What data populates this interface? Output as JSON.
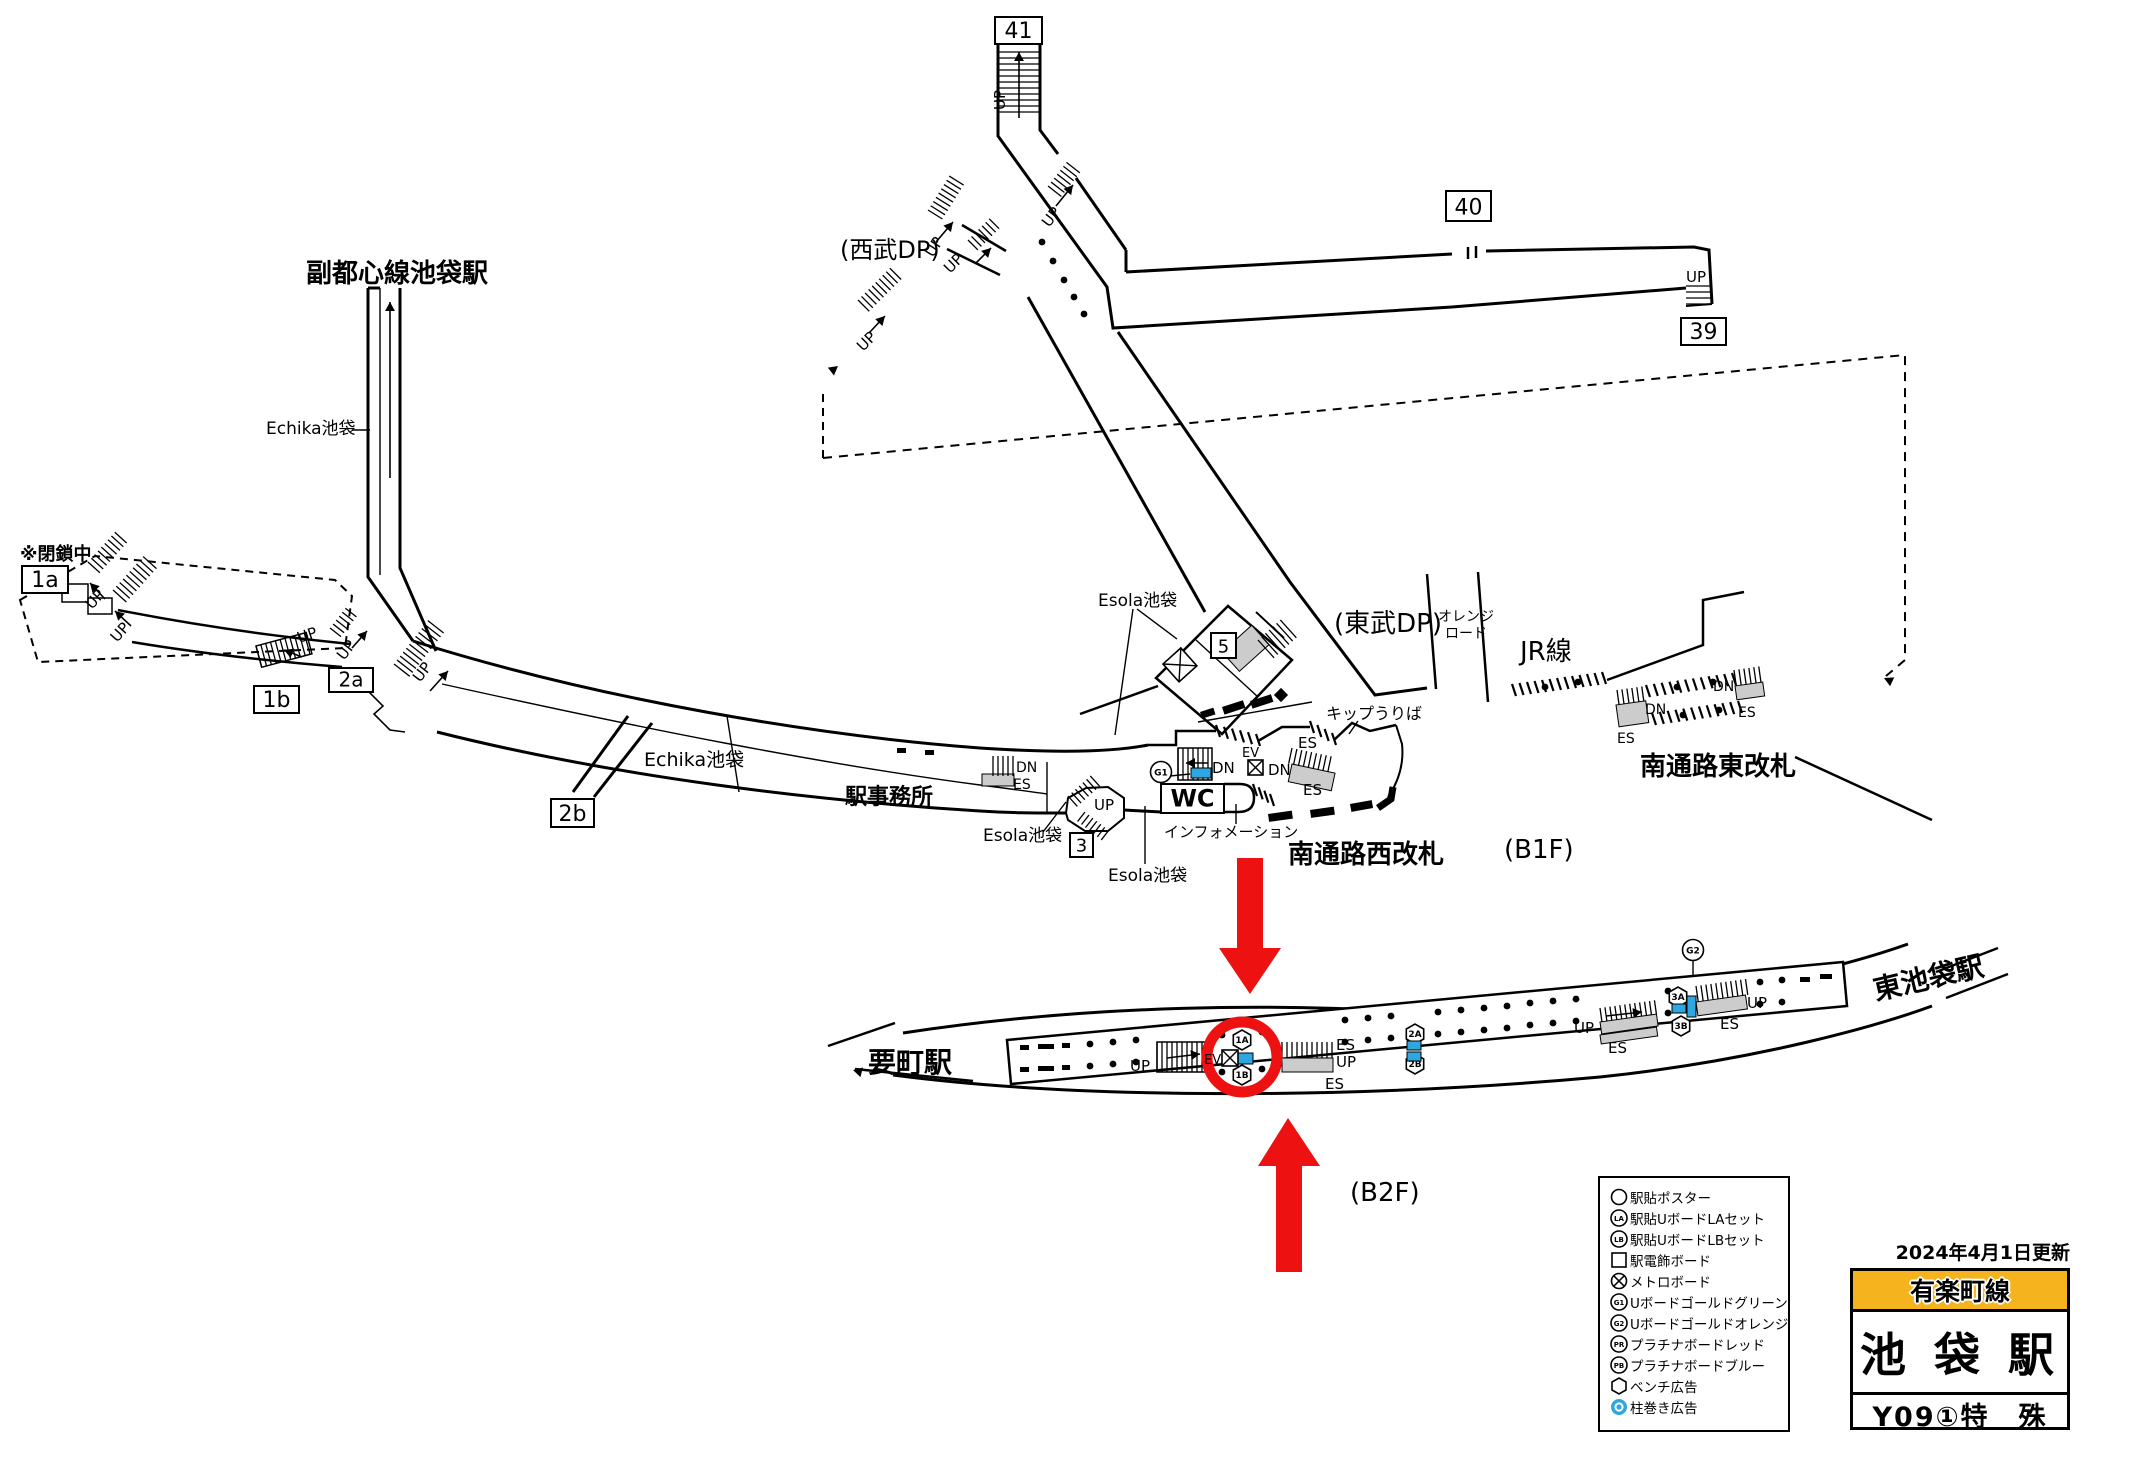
{
  "colors": {
    "accent_red": "#ee1111",
    "board_blue": "#2EA7E0",
    "line_yellow": "#F5B41E",
    "escalator_gray": "#cccccc"
  },
  "title_block": {
    "updated": "2024年4月1日更新",
    "line_name": "有楽町線",
    "station_name": "池 袋 駅",
    "station_code": "Y09①特　殊"
  },
  "legend": {
    "items": [
      {
        "type": "circle",
        "label": "駅貼ポスター"
      },
      {
        "type": "LA",
        "label": "駅貼UボードLAセット"
      },
      {
        "type": "LB",
        "label": "駅貼UボードLBセット"
      },
      {
        "type": "square",
        "label": "駅電飾ボード"
      },
      {
        "type": "xcircle",
        "label": "メトロボード"
      },
      {
        "type": "G1",
        "label": "Uボードゴールドグリーン"
      },
      {
        "type": "G2",
        "label": "Uボードゴールドオレンジ"
      },
      {
        "type": "PR",
        "label": "プラチナボードレッド"
      },
      {
        "type": "PB",
        "label": "プラチナボードブルー"
      },
      {
        "type": "hex",
        "label": "ベンチ広告"
      },
      {
        "type": "pillar",
        "label": "柱巻き広告"
      }
    ]
  },
  "map": {
    "labels": [
      {
        "id": "fukutoshin-label",
        "t": "副都心線池袋駅",
        "x": 306,
        "y": 282,
        "s": 26,
        "b": 1
      },
      {
        "id": "heisachu-label",
        "t": "※閉鎖中",
        "x": 20,
        "y": 560,
        "s": 18,
        "b": 1
      },
      {
        "id": "echika-upper-label",
        "t": "Echika池袋",
        "x": 266,
        "y": 434,
        "s": 17
      },
      {
        "id": "echika-mid-label",
        "t": "Echika池袋",
        "x": 644,
        "y": 766,
        "s": 19
      },
      {
        "id": "ekijimusho-label",
        "t": "駅事務所",
        "x": 845,
        "y": 804,
        "s": 22,
        "b": 1
      },
      {
        "id": "esola-3-label",
        "t": "Esola池袋",
        "x": 983,
        "y": 841,
        "s": 17
      },
      {
        "id": "esola-bottom-label",
        "t": "Esola池袋",
        "x": 1108,
        "y": 881,
        "s": 17
      },
      {
        "id": "esola-5-label",
        "t": "Esola池袋",
        "x": 1098,
        "y": 606,
        "s": 17
      },
      {
        "id": "seibu-dp-label",
        "t": "(西武DP)",
        "x": 840,
        "y": 258,
        "s": 24
      },
      {
        "id": "tobu-dp-label",
        "t": "(東武DP)",
        "x": 1334,
        "y": 632,
        "s": 26
      },
      {
        "id": "orange-road-label-1",
        "t": "オレンジ",
        "x": 1438,
        "y": 621,
        "s": 14
      },
      {
        "id": "orange-road-label-2",
        "t": "ロード",
        "x": 1445,
        "y": 638,
        "s": 14
      },
      {
        "id": "jr-line-label",
        "t": "JR線",
        "x": 1520,
        "y": 660,
        "s": 26
      },
      {
        "id": "kippu-uriba-label",
        "t": "キップうりば",
        "x": 1326,
        "y": 719,
        "s": 16
      },
      {
        "id": "information-label",
        "t": "インフォメーション",
        "x": 1164,
        "y": 837,
        "s": 15
      },
      {
        "id": "minami-west-gate-label",
        "t": "南通路西改札",
        "x": 1288,
        "y": 863,
        "s": 26,
        "b": 1
      },
      {
        "id": "b1f-label",
        "t": "(B1F)",
        "x": 1504,
        "y": 858,
        "s": 26
      },
      {
        "id": "minami-east-gate-label",
        "t": "南通路東改札",
        "x": 1640,
        "y": 775,
        "s": 26,
        "b": 1
      },
      {
        "id": "kanamecho-label",
        "t": "要町駅",
        "x": 868,
        "y": 1072,
        "s": 28,
        "b": 1
      },
      {
        "id": "higashi-ikebukuro-label",
        "t": "東池袋駅",
        "x": 1876,
        "y": 1000,
        "s": 28,
        "b": 1,
        "r": -13
      },
      {
        "id": "b2f-label",
        "t": "(B2F)",
        "x": 1350,
        "y": 1201,
        "s": 26
      },
      {
        "id": "up-41",
        "t": "UP",
        "x": 1005,
        "y": 110,
        "s": 15,
        "r": -90
      },
      {
        "id": "up-junction",
        "t": "UP",
        "x": 1049,
        "y": 228,
        "s": 15,
        "r": -52
      },
      {
        "id": "up-seibu-1",
        "t": "UP",
        "x": 933,
        "y": 258,
        "s": 15,
        "r": -58
      },
      {
        "id": "up-seibu-2",
        "t": "UP",
        "x": 950,
        "y": 274,
        "s": 15,
        "r": -45
      },
      {
        "id": "up-stray",
        "t": "UP",
        "x": 863,
        "y": 352,
        "s": 15,
        "r": -45
      },
      {
        "id": "up-39",
        "t": "UP",
        "x": 1686,
        "y": 282,
        "s": 15
      },
      {
        "id": "up-1a-1",
        "t": "UP",
        "x": 92,
        "y": 610,
        "s": 15,
        "r": -48
      },
      {
        "id": "up-1a-2",
        "t": "UP",
        "x": 117,
        "y": 643,
        "s": 15,
        "r": -48
      },
      {
        "id": "up-1b",
        "t": "UP",
        "x": 299,
        "y": 643,
        "s": 15,
        "r": -18
      },
      {
        "id": "up-2a-small",
        "t": "UP",
        "x": 344,
        "y": 661,
        "s": 15,
        "r": -52
      },
      {
        "id": "up-2a-big",
        "t": "UP",
        "x": 420,
        "y": 683,
        "s": 15,
        "r": -52
      },
      {
        "id": "up-exit3",
        "t": "UP",
        "x": 1094,
        "y": 810,
        "s": 15
      },
      {
        "id": "dn-west-stair",
        "t": "DN",
        "x": 1212,
        "y": 773,
        "s": 15
      },
      {
        "id": "ev-west",
        "t": "EV",
        "x": 1242,
        "y": 757,
        "s": 13
      },
      {
        "id": "dn-west-esc",
        "t": "DN",
        "x": 1268,
        "y": 775,
        "s": 15
      },
      {
        "id": "es-west-top",
        "t": "ES",
        "x": 1298,
        "y": 748,
        "s": 15
      },
      {
        "id": "es-west-bottom",
        "t": "ES",
        "x": 1303,
        "y": 795,
        "s": 15
      },
      {
        "id": "dn-band",
        "t": "DN",
        "x": 1016,
        "y": 772,
        "s": 14
      },
      {
        "id": "es-band",
        "t": "ES",
        "x": 1013,
        "y": 789,
        "s": 14
      },
      {
        "id": "dn-east-left",
        "t": "DN",
        "x": 1645,
        "y": 714,
        "s": 14
      },
      {
        "id": "es-east-left",
        "t": "ES",
        "x": 1617,
        "y": 743,
        "s": 14
      },
      {
        "id": "dn-east-right",
        "t": "DN",
        "x": 1713,
        "y": 691,
        "s": 14
      },
      {
        "id": "es-east-right",
        "t": "ES",
        "x": 1738,
        "y": 717,
        "s": 14
      },
      {
        "id": "ev-b2f",
        "t": "EV",
        "x": 1204,
        "y": 1064,
        "s": 13
      },
      {
        "id": "up-b2f-left",
        "t": "UP",
        "x": 1130,
        "y": 1071,
        "s": 15
      },
      {
        "id": "es-b2f-1",
        "t": "ES",
        "x": 1336,
        "y": 1050,
        "s": 15
      },
      {
        "id": "up-b2f-mid",
        "t": "UP",
        "x": 1336,
        "y": 1067,
        "s": 15
      },
      {
        "id": "es-b2f-2",
        "t": "ES",
        "x": 1325,
        "y": 1089,
        "s": 15
      },
      {
        "id": "up-b2f-3",
        "t": "UP",
        "x": 1574,
        "y": 1033,
        "s": 15
      },
      {
        "id": "es-b2f-3",
        "t": "ES",
        "x": 1608,
        "y": 1053,
        "s": 15
      },
      {
        "id": "up-b2f-right",
        "t": "UP",
        "x": 1747,
        "y": 1008,
        "s": 15
      },
      {
        "id": "es-b2f-right",
        "t": "ES",
        "x": 1720,
        "y": 1029,
        "s": 15
      }
    ],
    "boxed_labels": [
      {
        "id": "exit-41",
        "t": "41",
        "x": 995,
        "y": 17,
        "w": 47,
        "h": 27,
        "s": 22
      },
      {
        "id": "exit-40",
        "t": "40",
        "x": 1446,
        "y": 191,
        "w": 45,
        "h": 30,
        "s": 22
      },
      {
        "id": "exit-39",
        "t": "39",
        "x": 1681,
        "y": 318,
        "w": 45,
        "h": 27,
        "s": 22
      },
      {
        "id": "exit-1a",
        "t": "1a",
        "x": 22,
        "y": 566,
        "w": 46,
        "h": 27,
        "s": 22
      },
      {
        "id": "exit-1b",
        "t": "1b",
        "x": 254,
        "y": 686,
        "w": 45,
        "h": 27,
        "s": 22
      },
      {
        "id": "exit-2a",
        "t": "2a",
        "x": 329,
        "y": 668,
        "w": 44,
        "h": 24,
        "s": 20
      },
      {
        "id": "exit-2b",
        "t": "2b",
        "x": 551,
        "y": 799,
        "w": 43,
        "h": 28,
        "s": 22
      },
      {
        "id": "exit-3",
        "t": "3",
        "x": 1070,
        "y": 833,
        "w": 23,
        "h": 24,
        "s": 18
      },
      {
        "id": "exit-5",
        "t": "5",
        "x": 1211,
        "y": 633,
        "w": 25,
        "h": 25,
        "s": 18
      },
      {
        "id": "wc",
        "t": "WC",
        "x": 1161,
        "y": 784,
        "w": 63,
        "h": 29,
        "s": 24,
        "b": 1
      }
    ],
    "symbols": {
      "hex_badges": [
        {
          "label": "1A",
          "x": 1242,
          "y": 1040
        },
        {
          "label": "1B",
          "x": 1242,
          "y": 1075
        },
        {
          "label": "2A",
          "x": 1415,
          "y": 1034
        },
        {
          "label": "2B",
          "x": 1415,
          "y": 1064
        },
        {
          "label": "3A",
          "x": 1678,
          "y": 997
        },
        {
          "label": "3B",
          "x": 1681,
          "y": 1026
        }
      ],
      "circle_badges": [
        {
          "label": "G1",
          "x": 1161,
          "y": 772
        },
        {
          "label": "G2",
          "x": 1693,
          "y": 950
        }
      ],
      "blue_boards": [
        {
          "x": 1191,
          "y": 768,
          "w": 20,
          "h": 10,
          "r": 0
        },
        {
          "x": 1237,
          "y": 1053,
          "w": 16,
          "h": 11,
          "r": 0
        },
        {
          "x": 1407,
          "y": 1041,
          "w": 14,
          "h": 9,
          "r": 0
        },
        {
          "x": 1407,
          "y": 1052,
          "w": 14,
          "h": 9,
          "r": 0
        },
        {
          "x": 1672,
          "y": 1004,
          "w": 14,
          "h": 9,
          "r": 0
        },
        {
          "x": 1687,
          "y": 996,
          "w": 9,
          "h": 21,
          "r": 0
        }
      ],
      "x_boxes": [
        {
          "x": 1248,
          "y": 760,
          "w": 15,
          "r": 0
        },
        {
          "x": 1222,
          "y": 1050,
          "w": 16,
          "r": 0
        },
        {
          "x": 1163,
          "y": 664,
          "w": 24,
          "r": -42
        }
      ]
    }
  }
}
